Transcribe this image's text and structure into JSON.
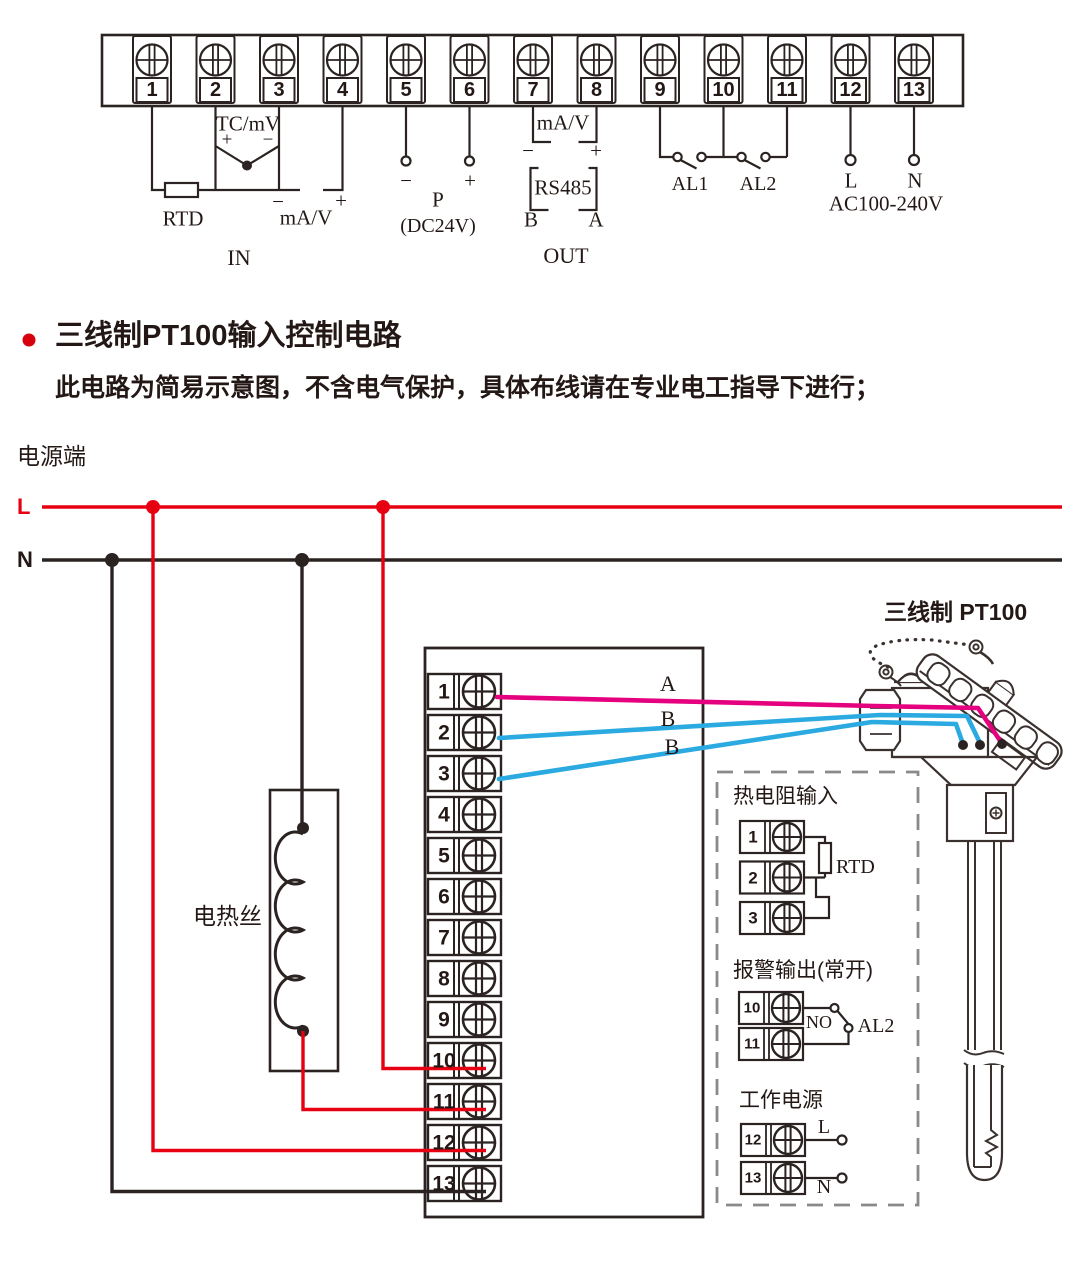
{
  "colors": {
    "ink": "#2b2321",
    "red": "#e60012",
    "magenta": "#e4007f",
    "blue": "#2aaae1",
    "dash_gray": "#8a8a8a",
    "bullet_red": "#d7000f",
    "text": "#231815"
  },
  "top_strip": {
    "terminals": [
      "1",
      "2",
      "3",
      "4",
      "5",
      "6",
      "7",
      "8",
      "9",
      "10",
      "11",
      "12",
      "13"
    ],
    "tc_mv": "TC/mV",
    "plus": "+",
    "minus": "−",
    "rtd": "RTD",
    "ma_v_in": "mA/V",
    "in_label": "IN",
    "p": "P",
    "dc24v": "(DC24V)",
    "ma_v_out": "mA/V",
    "rs485": "RS485",
    "b": "B",
    "a": "A",
    "out_label": "OUT",
    "al1": "AL1",
    "al2": "AL2",
    "l": "L",
    "n": "N",
    "ac_range": "AC100-240V"
  },
  "section": {
    "title": "三线制PT100输入控制电路",
    "note": "此电路为简易示意图，不含电气保护，具体布线请在专业电工指导下进行；"
  },
  "power": {
    "label": "电源端",
    "live": "L",
    "neutral": "N"
  },
  "circuit": {
    "heater_label": "电热丝",
    "sensor_label": "三线制 PT100",
    "wire_a": "A",
    "wire_b_upper": "B",
    "wire_b_lower": "B"
  },
  "main_block": {
    "terminals": [
      "1",
      "2",
      "3",
      "4",
      "5",
      "6",
      "7",
      "8",
      "9",
      "10",
      "11",
      "12",
      "13"
    ]
  },
  "detail_box": {
    "rtd": {
      "title": "热电阻输入",
      "terminals": [
        "1",
        "2",
        "3"
      ],
      "label": "RTD"
    },
    "alarm": {
      "title": "报警输出(常开)",
      "terminals": [
        "10",
        "11"
      ],
      "no_label": "NO",
      "al2_label": "AL2"
    },
    "supply": {
      "title": "工作电源",
      "terminals": [
        "12",
        "13"
      ],
      "live": "L",
      "neutral": "N"
    }
  }
}
